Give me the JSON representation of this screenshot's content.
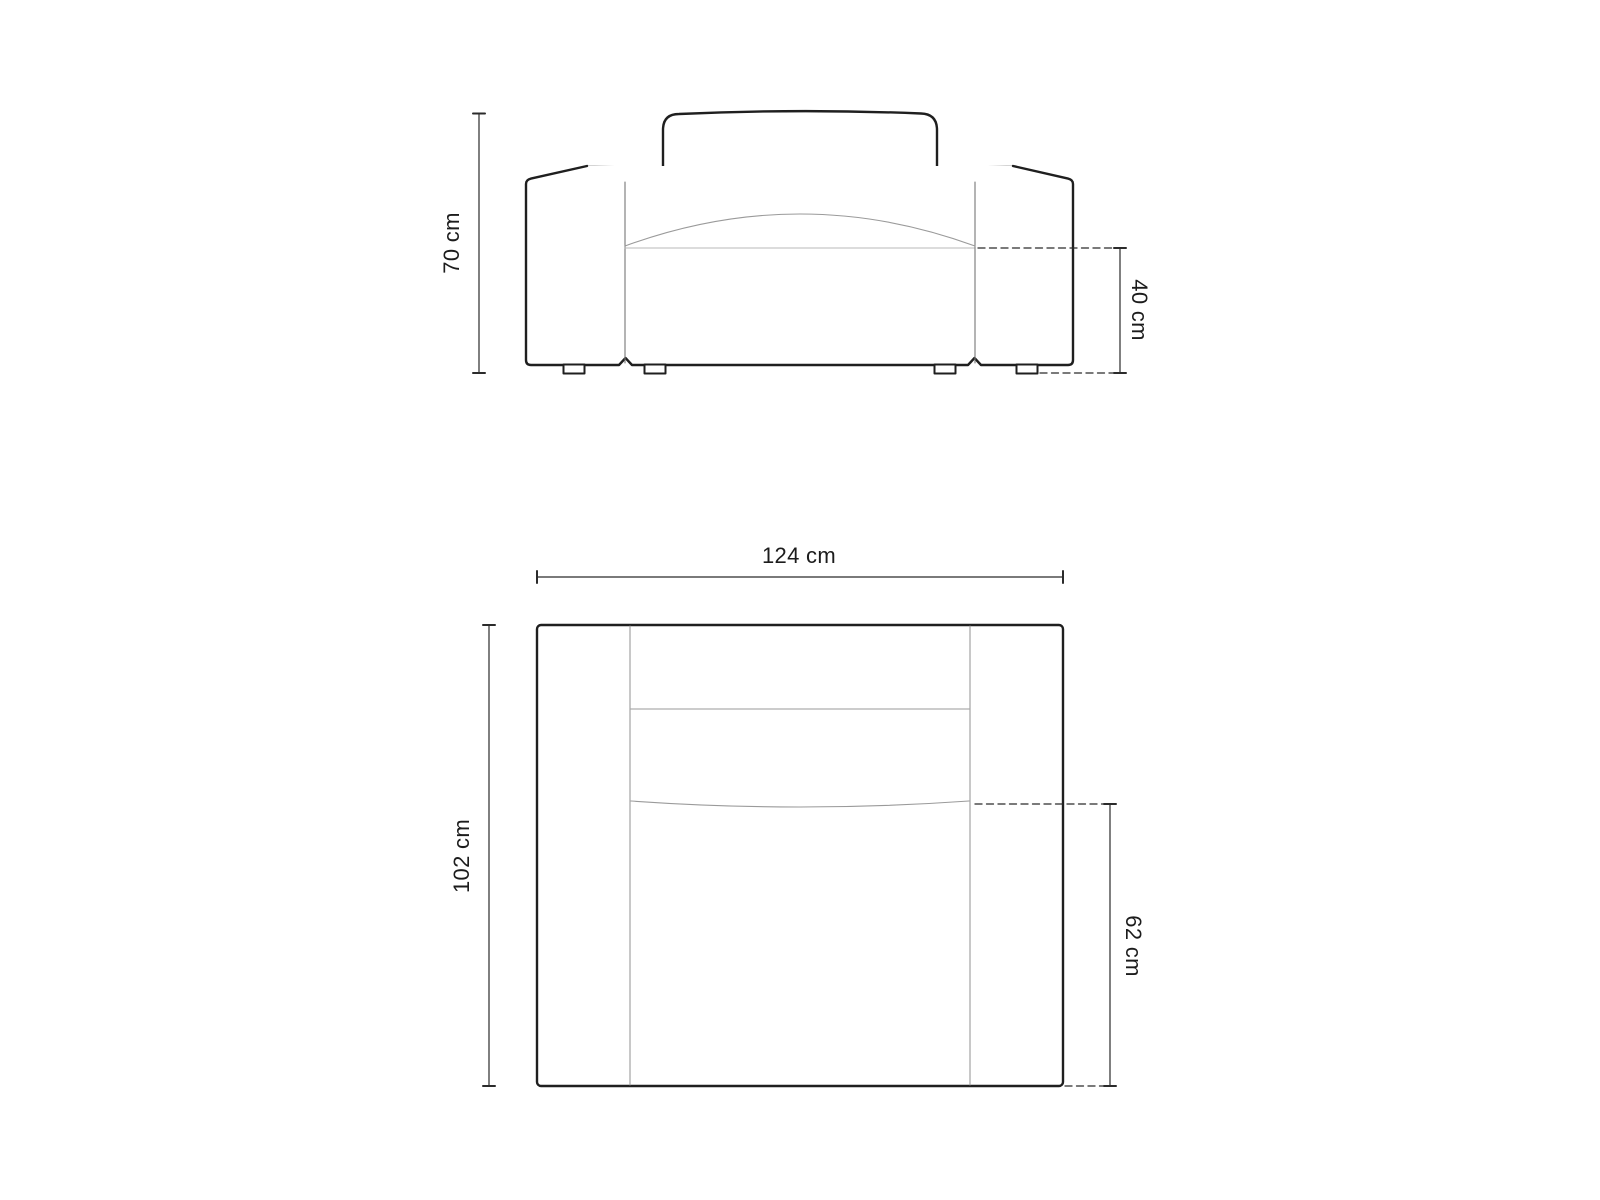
{
  "diagram": {
    "title": "armchair-dimension-drawing",
    "front_view": {
      "height_label": "70 cm",
      "seat_height_label": "40 cm"
    },
    "top_view": {
      "width_label": "124 cm",
      "depth_label": "102 cm",
      "seat_depth_label": "62 cm"
    },
    "colors": {
      "background": "#ffffff",
      "outline": "#1f1f1f",
      "thin_line": "#9a9a9a",
      "seat_line": "#b8b8b8",
      "dimension_line": "#2b2b2b",
      "label_text": "#1c1c1c"
    }
  }
}
